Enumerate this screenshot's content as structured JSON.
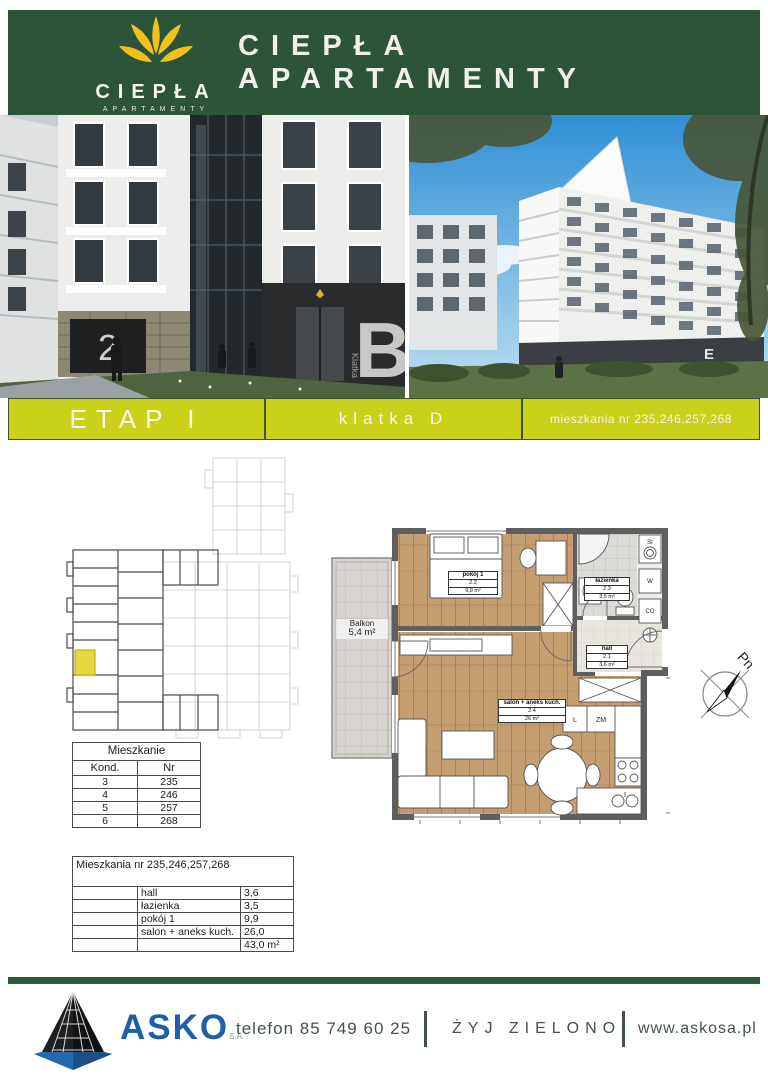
{
  "header": {
    "title": "CIEPŁA APARTAMENTY",
    "logo_brand": "CIEPŁA",
    "logo_sub": "APARTAMENTY",
    "bg_color": "#2b5438",
    "logo_flower_color": "#f0c11a"
  },
  "photos": {
    "left_entrance_letter": "B",
    "left_stair_label": "Klatka",
    "left_garage_number": "2",
    "right_entrance_letter": "E"
  },
  "banner": {
    "bg_color": "#cbd01b",
    "cells": [
      {
        "label": "ETAP I"
      },
      {
        "label": "klatka D"
      },
      {
        "label": "mieszkania nr 235,246,257,268"
      }
    ]
  },
  "floorplan": {
    "balcony": {
      "name": "Balkon",
      "area": "5,4 m²"
    },
    "rooms": [
      {
        "name": "pokój 1",
        "code": "2.2",
        "area": "9,9 m²"
      },
      {
        "name": "łazienka",
        "code": "2.3",
        "area": "3,5 m²"
      },
      {
        "name": "hall",
        "code": "2.1",
        "area": "3,6 m²"
      },
      {
        "name": "salon + aneks kuch.",
        "code": "2.4",
        "area": "26 m²"
      }
    ],
    "shafts": [
      "St",
      "W",
      "CO"
    ],
    "kitchen_labels": [
      "L",
      "ZM"
    ],
    "compass_label": "Pn",
    "highlight_color": "#e8d73e"
  },
  "apartments_table": {
    "title": "Mieszkanie",
    "columns": [
      "Kond.",
      "Nr"
    ],
    "rows": [
      [
        "3",
        "235"
      ],
      [
        "4",
        "246"
      ],
      [
        "5",
        "257"
      ],
      [
        "6",
        "268"
      ]
    ]
  },
  "areas_table": {
    "title": "Mieszkania nr  235,246,257,268",
    "rows": [
      [
        "hall",
        "3,6"
      ],
      [
        "łazienka",
        "3,5"
      ],
      [
        "pokój 1",
        "9,9"
      ],
      [
        "salon + aneks kuch.",
        "26,0"
      ]
    ],
    "total": "43,0 m²"
  },
  "footer": {
    "brand": "ASKO",
    "brand_suffix": "S.A.",
    "phone": "telefon 85 749 60 25",
    "slogan": "ŻYJ ZIELONO",
    "website": "www.askosa.pl"
  }
}
